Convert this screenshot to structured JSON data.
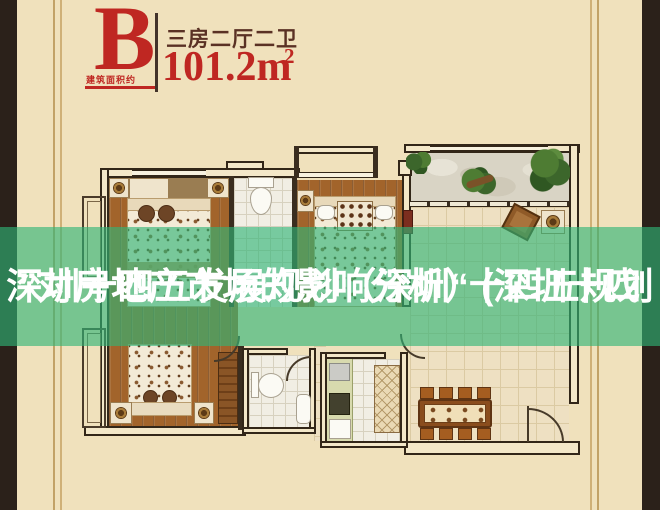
{
  "header": {
    "unit_letter": "B",
    "area_note": "建筑面积约",
    "layout_label": "三房二厅二卫",
    "area_value": "101.2",
    "area_unit": "m",
    "area_exponent": "2"
  },
  "overlay": {
    "line1": "深圳十四五发展规划（深圳“十四五规划",
    "line2": "”对房地产市场的影响分析）(深圳十四"
  },
  "floorplan": {
    "unit": "B",
    "rooms": [
      "bedroom-1",
      "bathroom-1",
      "bedroom-2",
      "balcony",
      "living-room",
      "bedroom-3",
      "bathroom-2",
      "kitchen",
      "dining-area"
    ]
  },
  "colors": {
    "background_beige": "#f0e1bc",
    "frame_dark": "#2b211a",
    "frame_line_tan": "#c2a267",
    "accent_red": "#bf2722",
    "layout_text_brown": "#5a3124",
    "overlay_green": "rgba(47,180,118,0.63)",
    "overlay_text": "#ffffff",
    "wall_outline": "#322618",
    "wood_floor": "#a2642b",
    "plant_green": "#4e7c33"
  }
}
